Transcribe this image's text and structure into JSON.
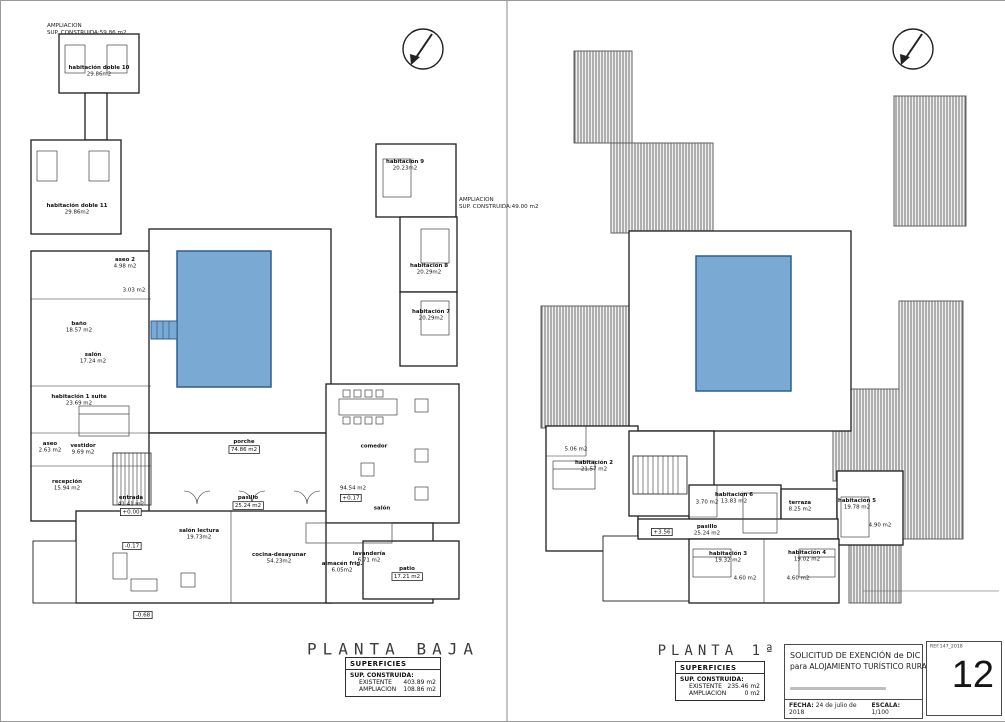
{
  "sheet": {
    "number": "12",
    "ref": "REF.147_2018"
  },
  "title_block": {
    "line1": "SOLICITUD DE EXENCIÓN de DIC",
    "line2": "para ALOJAMIENTO TURÍSTICO RURAL",
    "fecha_label": "FECHA:",
    "fecha_value": "24 de julio de 2018",
    "escala_label": "ESCALA:",
    "escala_value": "1/100"
  },
  "colors": {
    "pool_fill": "#7aa9d4",
    "pool_border": "#2f5e8c",
    "wall": "#1d1d1d",
    "hatch_line": "#6e6e6e"
  },
  "icons": [
    "north-arrow-icon"
  ],
  "plans": [
    {
      "id": "planta-baja",
      "title": "PLANTA BAJA",
      "superficies": {
        "header": "SUPERFICIES",
        "sub": "SUP. CONSTRUIDA:",
        "rows": [
          [
            "EXISTENTE",
            "403.89 m2"
          ],
          [
            "AMPLIACION",
            "108.86 m2"
          ]
        ]
      },
      "notes": [
        {
          "lines": [
            "AMPLIACION",
            "SUP. CONSTRUIDA:59.86 m2"
          ],
          "x": 46,
          "y": 21
        },
        {
          "lines": [
            "AMPLIACION",
            "SUP. CONSTRUIDA:49.00 m2"
          ],
          "x": 458,
          "y": 195
        }
      ],
      "labels": [
        {
          "t": "habitación doble 10",
          "a": "29.86m2",
          "x": 98,
          "y": 70
        },
        {
          "t": "habitación doble 11",
          "a": "29.86m2",
          "x": 76,
          "y": 208
        },
        {
          "t": "habitación 9",
          "a": "20.23m2",
          "x": 404,
          "y": 164
        },
        {
          "t": "habitación 8",
          "a": "20.29m2",
          "x": 428,
          "y": 268
        },
        {
          "t": "habitación 7",
          "a": "20.29m2",
          "x": 430,
          "y": 314
        },
        {
          "t": "aseo 2",
          "a": "4.98 m2",
          "x": 124,
          "y": 262
        },
        {
          "t": "",
          "a": "3.03 m2",
          "x": 133,
          "y": 289
        },
        {
          "t": "baño",
          "a": "18.57 m2",
          "x": 78,
          "y": 326
        },
        {
          "t": "salón",
          "a": "17.24 m2",
          "x": 92,
          "y": 357
        },
        {
          "t": "habitación 1 suite",
          "a": "23.69 m2",
          "x": 78,
          "y": 399
        },
        {
          "t": "aseo",
          "a": "2.63 m2",
          "x": 49,
          "y": 446
        },
        {
          "t": "vestidor",
          "a": "9.69 m2",
          "x": 82,
          "y": 448
        },
        {
          "t": "recepción",
          "a": "15.94 m2",
          "x": 66,
          "y": 484
        },
        {
          "t": "entrada",
          "a": "41.41 m2",
          "x": 130,
          "y": 500
        },
        {
          "t": "porche",
          "a": "74.86 m2",
          "x": 243,
          "y": 445,
          "boxed": true
        },
        {
          "t": "pasillo",
          "a": "25.24 m2",
          "x": 247,
          "y": 501,
          "boxed": true
        },
        {
          "t": "salón lectura",
          "a": "19.73m2",
          "x": 198,
          "y": 533
        },
        {
          "t": "cocina-desayunar",
          "a": "54.23m2",
          "x": 278,
          "y": 557
        },
        {
          "t": "comedor",
          "a": "",
          "x": 373,
          "y": 445
        },
        {
          "t": "",
          "a": "94.54 m2",
          "x": 352,
          "y": 487
        },
        {
          "t": "salón",
          "a": "",
          "x": 381,
          "y": 507
        },
        {
          "t": "lavandería",
          "a": "6.71 m2",
          "x": 368,
          "y": 556
        },
        {
          "t": "almacén frig.",
          "a": "6.05m2",
          "x": 341,
          "y": 566
        },
        {
          "t": "patio",
          "a": "17.21 m2",
          "x": 406,
          "y": 572,
          "boxed": true
        }
      ],
      "levels": [
        {
          "v": "+0.00",
          "x": 130,
          "y": 511
        },
        {
          "v": "+0.17",
          "x": 350,
          "y": 497
        },
        {
          "v": "-0.17",
          "x": 131,
          "y": 545
        },
        {
          "v": "-0.68",
          "x": 142,
          "y": 614
        }
      ]
    },
    {
      "id": "planta-primera",
      "title": "PLANTA 1ª",
      "superficies": {
        "header": "SUPERFICIES",
        "sub": "SUP. CONSTRUIDA:",
        "rows": [
          [
            "EXISTENTE",
            "235.46 m2"
          ],
          [
            "AMPLIACION",
            "0 m2"
          ]
        ]
      },
      "notes": [],
      "labels": [
        {
          "t": "habitación 2",
          "a": "21.57 m2",
          "x": 593,
          "y": 465
        },
        {
          "t": "",
          "a": "5.06 m2",
          "x": 575,
          "y": 448
        },
        {
          "t": "",
          "a": "3.70 m2",
          "x": 706,
          "y": 501
        },
        {
          "t": "habitación 6",
          "a": "13.83 m2",
          "x": 733,
          "y": 497
        },
        {
          "t": "terraza",
          "a": "8.25 m2",
          "x": 799,
          "y": 505
        },
        {
          "t": "habitación 5",
          "a": "19.78 m2",
          "x": 856,
          "y": 503
        },
        {
          "t": "",
          "a": "4.90 m2",
          "x": 879,
          "y": 524
        },
        {
          "t": "pasillo",
          "a": "25.24 m2",
          "x": 706,
          "y": 529
        },
        {
          "t": "habitación 3",
          "a": "19.32 m2",
          "x": 727,
          "y": 556
        },
        {
          "t": "habitación 4",
          "a": "19.02 m2",
          "x": 806,
          "y": 555
        },
        {
          "t": "",
          "a": "4.60 m2",
          "x": 744,
          "y": 577
        },
        {
          "t": "",
          "a": "4.60 m2",
          "x": 797,
          "y": 577
        }
      ],
      "levels": [
        {
          "v": "+3.56",
          "x": 661,
          "y": 531
        }
      ]
    }
  ]
}
